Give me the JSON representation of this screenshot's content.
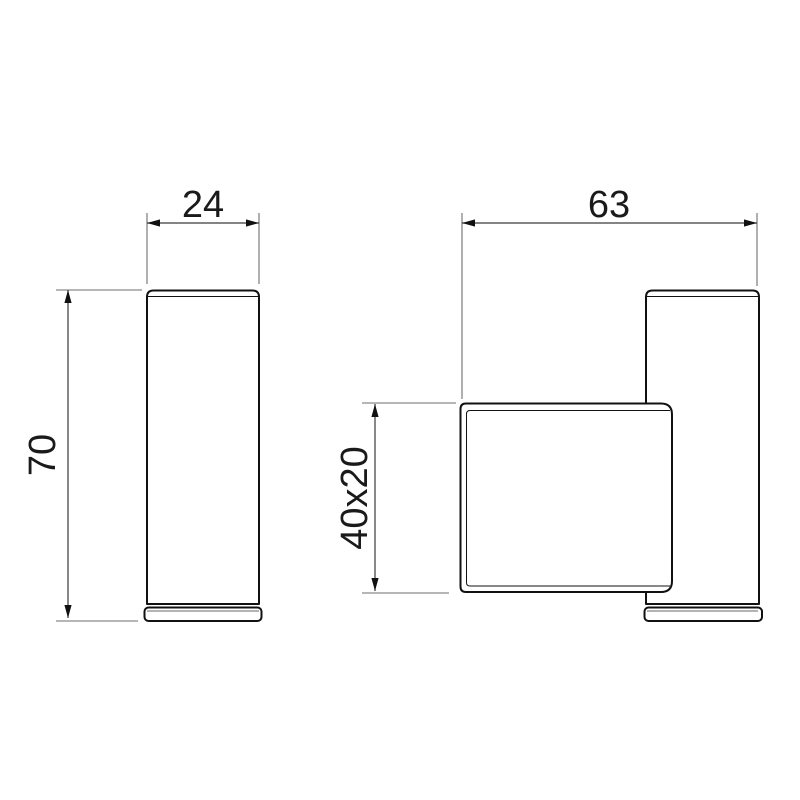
{
  "drawing": {
    "type": "technical-dimension-drawing",
    "subject": "wall hook two orthographic views",
    "labels": {
      "front_width": "24",
      "side_depth": "63",
      "front_height": "70",
      "profile": "40x20"
    },
    "colors": {
      "background": "#ffffff",
      "outline": "#111111",
      "dimension_line": "#3a3a3a",
      "extension_line": "#6e6e6e",
      "accent_gray": "#9a9a9a",
      "text": "#1a1a1a"
    }
  }
}
